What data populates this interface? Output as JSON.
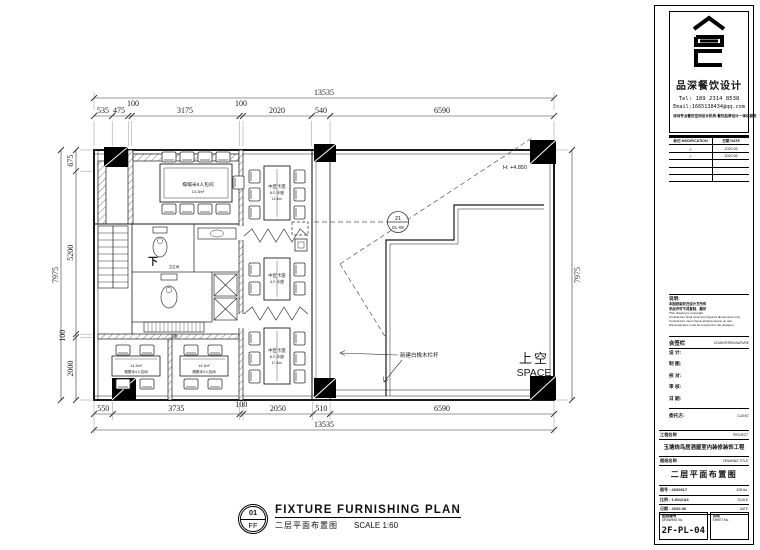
{
  "sheet": {
    "bg": "#ffffff",
    "ink": "#1a1a1a"
  },
  "drawing": {
    "dims": {
      "top_total": "13535",
      "top": [
        "535",
        "475",
        "100",
        "3175",
        "100",
        "2020",
        "540",
        "6590"
      ],
      "left": [
        "675",
        "5200",
        "100",
        "2000"
      ],
      "left_total": "7975",
      "right_total": "7975",
      "bottom": [
        "550",
        "3735",
        "100",
        "2050",
        "510",
        "6590"
      ],
      "bottom_total": "13535"
    },
    "labels": {
      "room_top": "榻榻米8人包间",
      "room_top_area": "14.3m²",
      "booth1_l1": "中区卡座",
      "booth1_l2": "6人卡座",
      "booth1_area": "14.3m²",
      "booth2_l1": "中区卡座",
      "booth2_l2": "4人卡座",
      "booth3_l1": "中区卡座",
      "booth3_l2": "6人卡座",
      "booth3_area": "17.3m²",
      "room_bl_area": "14.3m²",
      "room_bl": "榻榻米4人包间",
      "room_br_area": "14.3m²",
      "room_br": "榻榻米4人包间",
      "stair": "下",
      "wc": "卫生间",
      "corridor": "走廊",
      "height": "H: +4.850",
      "void_cn": "上空",
      "void_en": "SPACE",
      "railing_note": "新建白橡木栏杆",
      "balloon_no": "21",
      "balloon_ref": "DL-08"
    },
    "caption": {
      "num": "01",
      "floor": "FF",
      "title": "FIXTURE FURNISHING PLAN",
      "subtitle": "二层平面布置图",
      "scale": "SCALE 1:60"
    }
  },
  "titleblock": {
    "brand": {
      "company": "品深餐饮设计",
      "tel": "Tel: 189 2314 8538",
      "email": "Email:1665138434@qq.com",
      "slogan": "深圳专业餐饮空间设计机构·餐饮品牌设计一体化服务"
    },
    "revisions": {
      "col_mark": "标记 MODIFICATION",
      "col_date": "日期 DATE",
      "rows": [
        {
          "mark": "△",
          "date": "2020.05"
        },
        {
          "mark": "△",
          "date": "2020.06"
        },
        {
          "mark": "",
          "date": ""
        },
        {
          "mark": "",
          "date": ""
        },
        {
          "mark": "",
          "date": ""
        }
      ]
    },
    "notes": {
      "title": "说明:",
      "cn_lines": [
        "本图纸版权归设计方所有",
        "未经许可不得复制、翻印"
      ],
      "en_lines": [
        "This drawing is copyright.",
        "Contractors shall work from figured dimensions only.",
        "Contractors must check all dimensions on site.",
        "Discrepancies must be reported to the designer."
      ]
    },
    "countersign": {
      "cn": "会签栏",
      "en": "COUNTERSIGNATURE"
    },
    "sign_fields": [
      "设 计:",
      "制 图:",
      "校 对:",
      "审 核:",
      "日 期:"
    ],
    "client": {
      "cn": "委托方:",
      "en": "CLIENT"
    },
    "project": {
      "label": "工程名称",
      "en": "PROJECT",
      "value": "玉塘烧鸟居酒屋室内装修装饰工程"
    },
    "drawing_title": {
      "label": "图纸名称",
      "en": "DRAWING TITLE",
      "value": "二层平面布置图"
    },
    "meta": [
      {
        "label": "图号 : 2020617",
        "en": "JOB No."
      },
      {
        "label": "比例 : 1:60@A3",
        "en": "SCALE"
      },
      {
        "label": "日期 : 2020.06",
        "en": "DATE"
      }
    ],
    "number": {
      "label": "图纸编号",
      "en": "DRAWING No.",
      "value": "2F-PL-04"
    },
    "sheet_no": {
      "label": "页码",
      "en": "SHEET No."
    }
  }
}
